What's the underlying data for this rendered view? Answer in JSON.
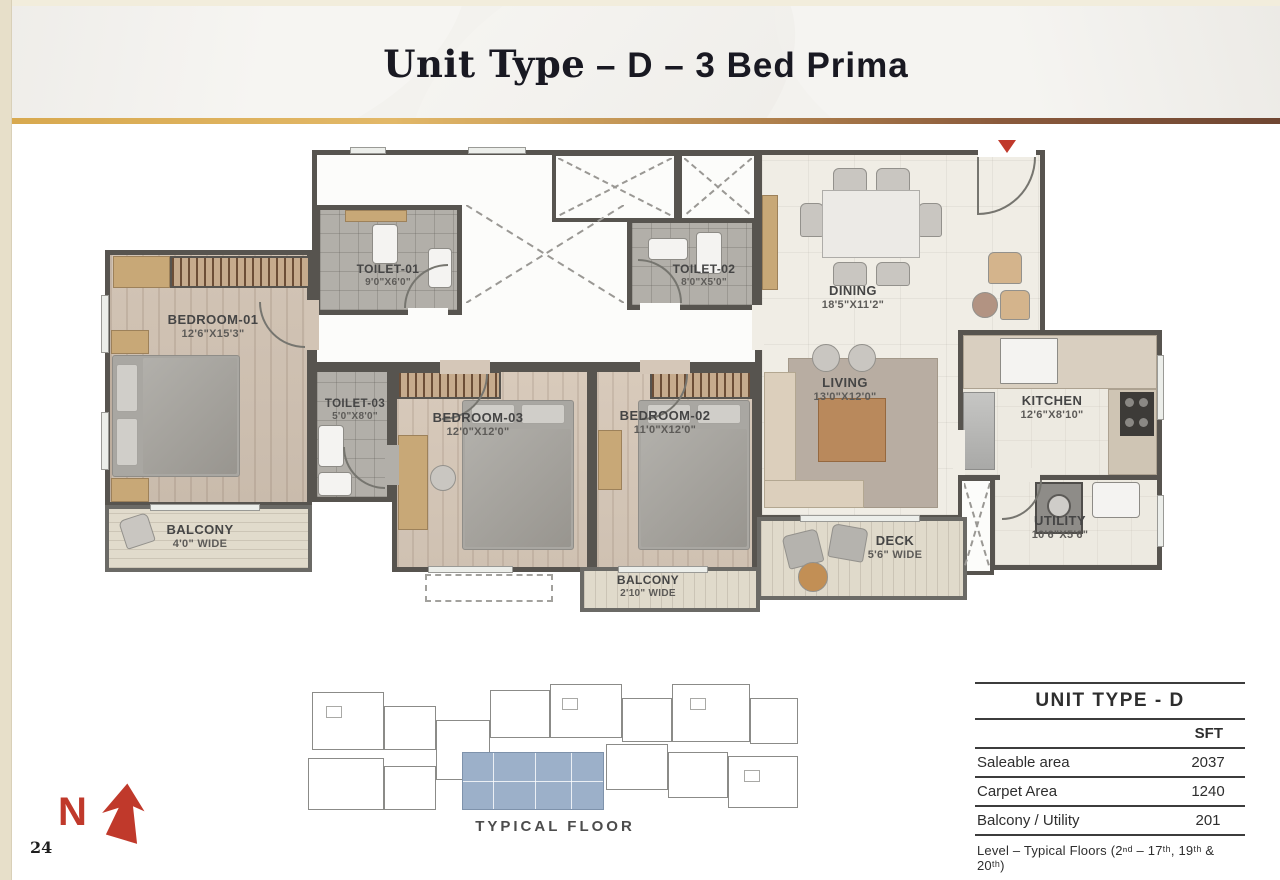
{
  "page": {
    "number": "24"
  },
  "header": {
    "title_serif": "Unit Type",
    "title_sans": " – D – 3 Bed Prima"
  },
  "north": {
    "label": "N"
  },
  "colors": {
    "accent_red": "#c0392b",
    "wall": "#57544f",
    "gold": "#d8a94f",
    "brown": "#6f4632",
    "keyplan_highlight": "#9cb0c9"
  },
  "floorplan": {
    "rooms": {
      "bedroom1": {
        "name": "BEDROOM-01",
        "dims": "12'6\"X15'3\""
      },
      "bedroom2": {
        "name": "BEDROOM-02",
        "dims": "11'0\"X12'0\""
      },
      "bedroom3": {
        "name": "BEDROOM-03",
        "dims": "12'0\"X12'0\""
      },
      "toilet1": {
        "name": "TOILET-01",
        "dims": "9'0\"X6'0\""
      },
      "toilet2": {
        "name": "TOILET-02",
        "dims": "8'0\"X5'0\""
      },
      "toilet3": {
        "name": "TOILET-03",
        "dims": "5'0\"X8'0\""
      },
      "dining": {
        "name": "DINING",
        "dims": "18'5\"X11'2\""
      },
      "living": {
        "name": "LIVING",
        "dims": "13'0\"X12'0\""
      },
      "kitchen": {
        "name": "KITCHEN",
        "dims": "12'6\"X8'10\""
      },
      "utility": {
        "name": "UTILITY",
        "dims": "10'6\"X5'6\""
      },
      "balcony1": {
        "name": "BALCONY",
        "dims": "4'0\" WIDE"
      },
      "balcony2": {
        "name": "BALCONY",
        "dims": "2'10\" WIDE"
      },
      "deck": {
        "name": "DECK",
        "dims": "5'6\" WIDE"
      }
    },
    "keyplan_label": "TYPICAL FLOOR"
  },
  "table": {
    "title": "UNIT TYPE - D",
    "unit_header": "SFT",
    "rows": [
      {
        "label": "Saleable area",
        "value": "2037"
      },
      {
        "label": "Carpet Area",
        "value": "1240"
      },
      {
        "label": "Balcony / Utility",
        "value": "201"
      }
    ],
    "footer": "Level – Typical Floors (2ⁿᵈ – 17ᵗʰ, 19ᵗʰ & 20ᵗʰ)"
  }
}
